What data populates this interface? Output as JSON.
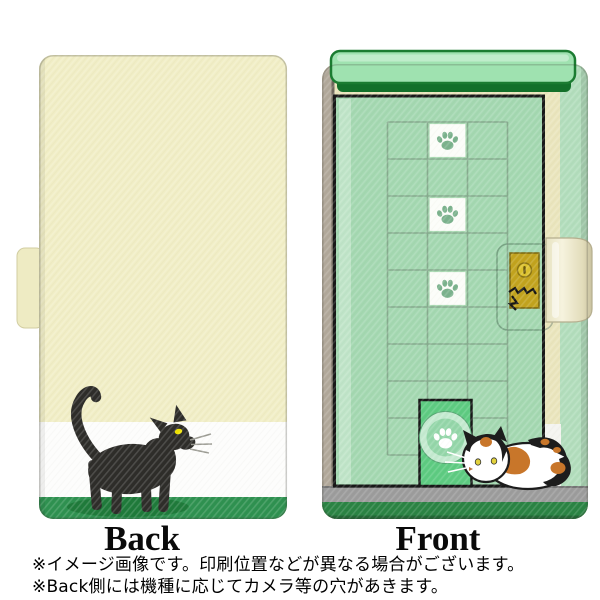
{
  "labels": {
    "back": "Back",
    "front": "Front"
  },
  "notes": [
    "※イメージ画像です。印刷位置などが異なる場合がございます。",
    "※Back側には機種に応じてカメラ等の穴があきます。"
  ],
  "colors": {
    "back_cream": "#f1eec6",
    "band_white": "#fdfdfc",
    "band_green": "#2e9150",
    "cat_shadow_green": "#1e7a3a",
    "black_cat": "#2d2c29",
    "cat_eye_yellow": "#f0e300",
    "whisker_gray": "#9b9b93",
    "spine_tan": "#b1a89a",
    "edge_cream": "#eae5bd",
    "edge_green": "#b2ddbc",
    "cover_green": "#a4d8b1",
    "awning_green": "#9fe2b0",
    "awning_border": "#1b7c31",
    "awning_lip": "#13702a",
    "grid_line": "#83a78b",
    "paw_green": "#7bb28d",
    "paw_cell_white": "#fcfdf9",
    "catdoor_green": "#5dcb81",
    "door_circle_outer": "#c4ead0",
    "door_circle_inner": "#94d6a9",
    "door_paw_white": "#ffffff",
    "floor_gray": "#9c9c9c",
    "bottom_green": "#2a8343",
    "clasp_gold": "#c2a31d",
    "strap_cream": "#efeacd",
    "calico_white": "#ffffff",
    "calico_orange": "#c8762a",
    "calico_black": "#1d1d1d",
    "calico_eye": "#e3d23c",
    "outline_black": "#171717"
  }
}
